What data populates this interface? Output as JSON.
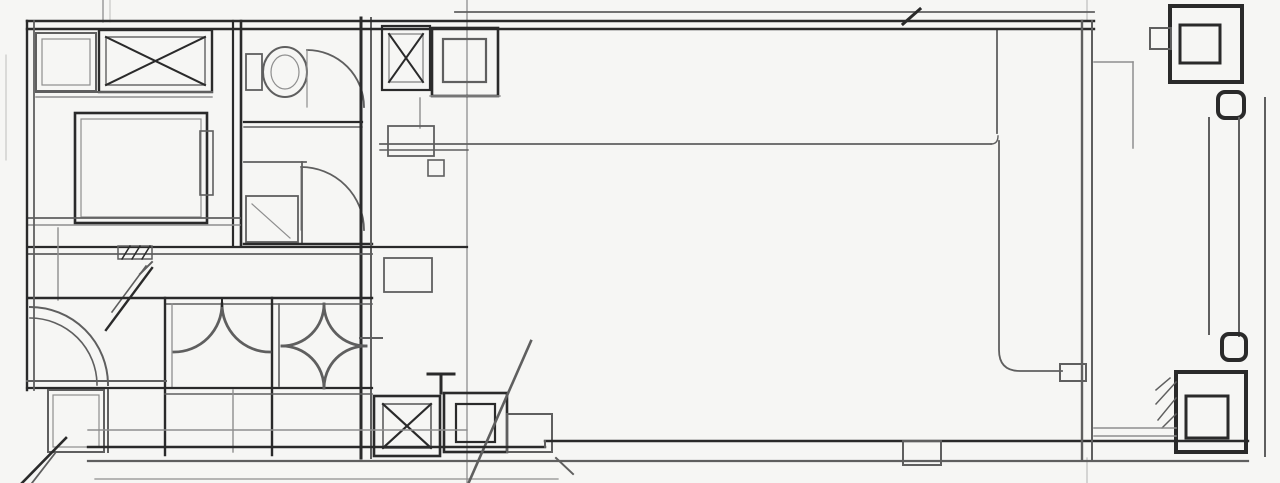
{
  "document": {
    "kind": "scanned architectural floor plan",
    "style": "black-and-white blueprint scan, single office floor plate"
  },
  "labels": {
    "elevator": "ELV"
  },
  "smudged_labels": [
    "small illegible room label near elevator lobby",
    "small illegible room label in lower-left service room"
  ],
  "symbols": {
    "x-hatched-box": "ventilation / pipe shaft",
    "nested-square": "structural column or skylight box",
    "quarter-arc": "door swing",
    "fan-arcs-cell": "stair flight cell",
    "astroid-cell": "shaft / void cell",
    "toilet-fixture": "WC bowl with tank"
  },
  "colors": {
    "paper": "#f6f6f4",
    "ink_dark": "#2a2a2a",
    "ink_medium": "#5f5f5f",
    "ink_light": "#8e8e8e",
    "ink_faint": "#bdbdbd",
    "label_ink": "#3f3f3f"
  }
}
